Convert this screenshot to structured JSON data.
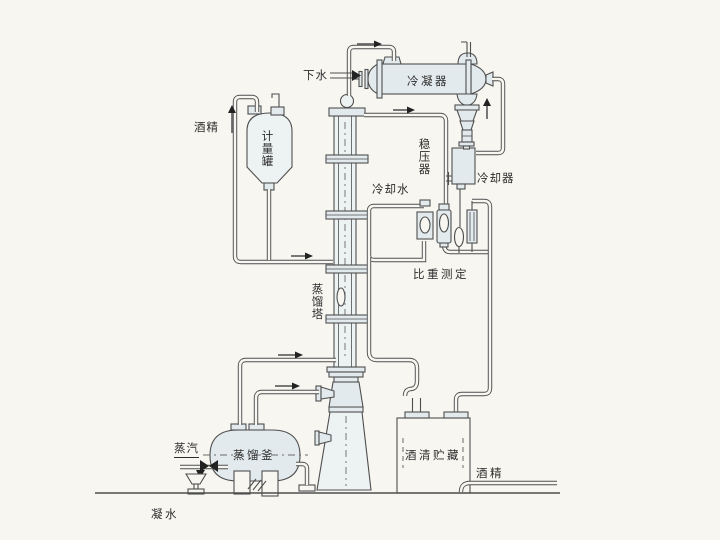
{
  "colors": {
    "background": "#f7f6f1",
    "line": "#4f4f4f",
    "vessel_fill": "#e2eaed",
    "vessel_fill_light": "#edf2f3",
    "arrow": "#222222"
  },
  "labels": {
    "drain_water": "下水",
    "condenser": "冷凝器",
    "alcohol_feed": "酒精",
    "metering_tank": "计量罐",
    "pressure_stabilizer": "稳压器",
    "cooling_water": "冷却水",
    "cooler": "冷却器",
    "specific_gravity_measurement": "比重测定",
    "distillation_tower": "蒸馏塔",
    "distillation_kettle": "蒸馏釜",
    "steam": "蒸汽",
    "condensate_water": "凝水",
    "alcohol_storage": "酒清贮藏",
    "alcohol_out": "酒精"
  }
}
